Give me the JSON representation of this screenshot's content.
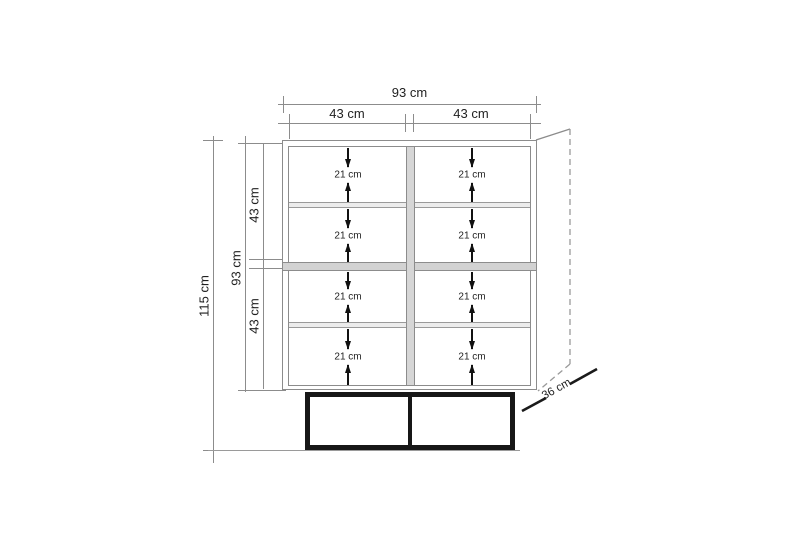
{
  "diagram": {
    "unit": "cm",
    "top_dimensions": {
      "overall_width": "93 cm",
      "sections": [
        {
          "label": "43 cm"
        },
        {
          "label": "43 cm"
        }
      ]
    },
    "left_dimensions": {
      "total_height": "115 cm",
      "body_height": "93 cm",
      "upper_section": "43 cm",
      "lower_section": "43 cm"
    },
    "depth": "36 cm",
    "compartments": [
      {
        "label": "21 cm"
      },
      {
        "label": "21 cm"
      },
      {
        "label": "21 cm"
      },
      {
        "label": "21 cm"
      },
      {
        "label": "21 cm"
      },
      {
        "label": "21 cm"
      },
      {
        "label": "21 cm"
      },
      {
        "label": "21 cm"
      }
    ]
  },
  "colors": {
    "line": "#8c8c8c",
    "line-light": "#9a9a9a",
    "text": "#1f1f1f",
    "base": "#171717",
    "shelf-mid": "#d2d2d2",
    "shelf-thin": "#ececec",
    "divider": "#d6d6d6",
    "arrow": "#111111",
    "bg": "#ffffff"
  }
}
